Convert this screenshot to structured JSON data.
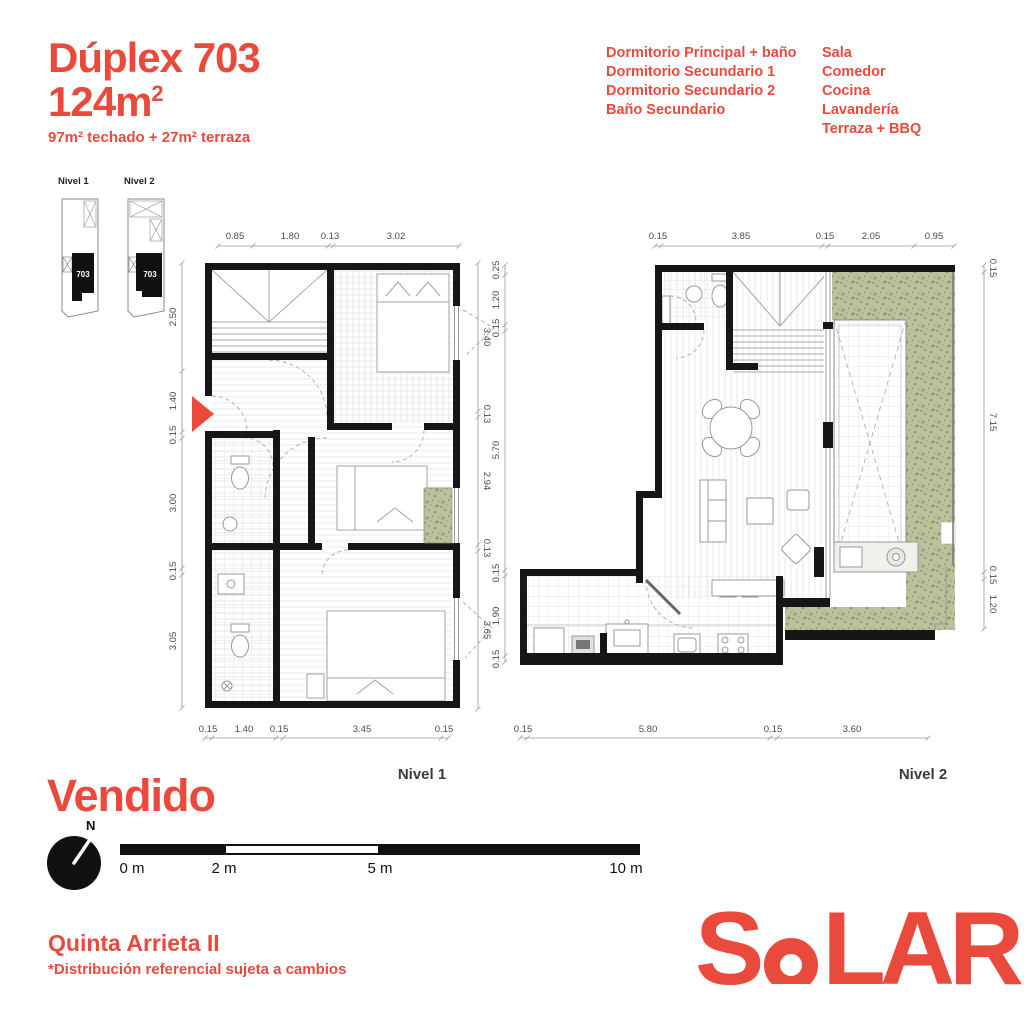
{
  "header": {
    "title": "Dúplex 703",
    "area": "124m",
    "area_sup": "2",
    "subtitle": "97m² techado + 27m² terraza",
    "features_col1": [
      "Dormitorio Principal + baño",
      "Dormitorio Secundario 1",
      "Dormitorio Secundario 2",
      "Baño Secundario"
    ],
    "features_col2": [
      "Sala",
      "Comedor",
      "Cocina",
      "Lavandería",
      "Terraza + BBQ"
    ]
  },
  "key_plans": {
    "nivel1_label": "Nivel 1",
    "nivel2_label": "Nivel 2",
    "unit_number": "703"
  },
  "plans": {
    "nivel1": {
      "label": "Nivel 1",
      "dims_top": [
        "0.85",
        "1.80",
        "0.13",
        "3.02"
      ],
      "dims_left": [
        "2.50",
        "1.40",
        "0.15",
        "3.00",
        "0.15",
        "3.05"
      ],
      "dims_right": [
        "3.40",
        "0.13",
        "2.94",
        "0.13",
        "3.65"
      ],
      "dims_bottom": [
        "0.15",
        "1.40",
        "0.15",
        "3.45",
        "0.15"
      ]
    },
    "nivel2": {
      "label": "Nivel 2",
      "dims_top": [
        "0.15",
        "3.85",
        "0.15",
        "2.05",
        "0.95"
      ],
      "dims_left": [
        "0.25",
        "1.20",
        "0.15",
        "5.70",
        "0.15",
        "1.90",
        "0.15"
      ],
      "dims_right": [
        "0.15",
        "7.15",
        "0.15",
        "1.20"
      ],
      "dims_bottom": [
        "0.15",
        "5.80",
        "0.15",
        "3.60"
      ]
    }
  },
  "status": {
    "label": "Vendido"
  },
  "compass": {
    "north_label": "N"
  },
  "scale_bar": {
    "labels": [
      "0 m",
      "2 m",
      "5 m",
      "10 m"
    ]
  },
  "footer": {
    "project_name": "Quinta Arrieta II",
    "disclaimer": "*Distribución referencial sujeta a cambios",
    "logo_part1": "S",
    "logo_part2": "LAR"
  },
  "colors": {
    "accent": "#EA4A3C",
    "wall": "#161616",
    "terrace_green": "#BCC19D"
  }
}
